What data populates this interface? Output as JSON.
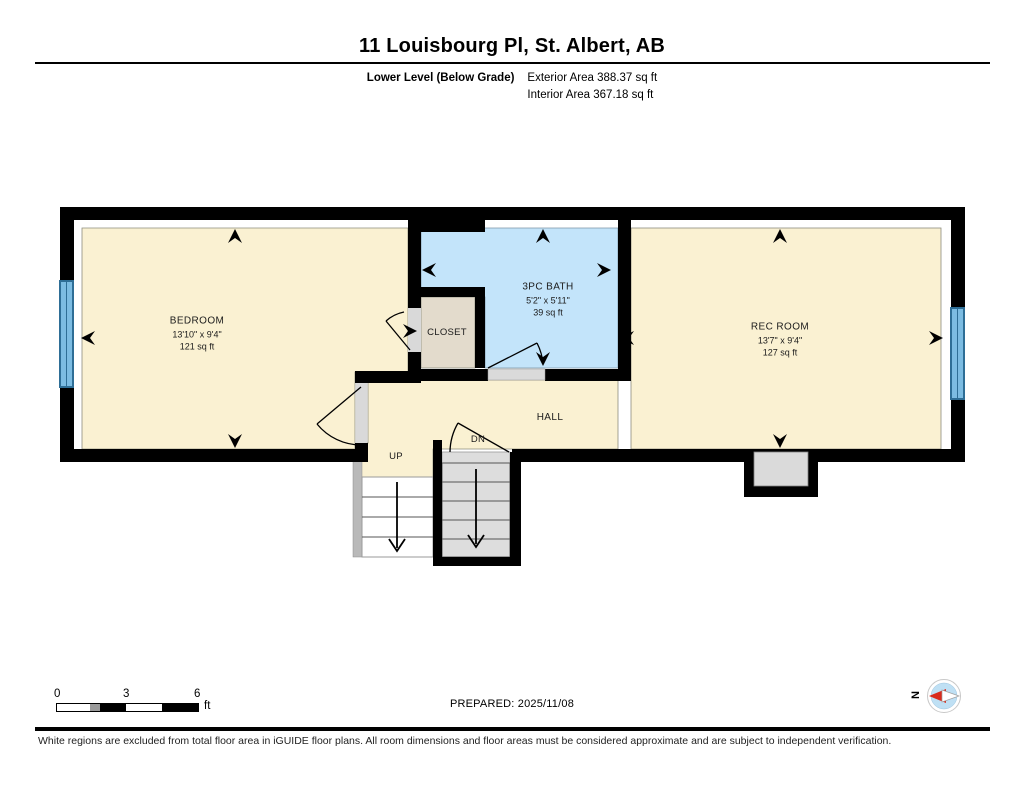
{
  "header": {
    "title": "11 Louisbourg Pl, St. Albert, AB",
    "level_label": "Lower Level (Below Grade)",
    "exterior_area": "Exterior Area 388.37 sq ft",
    "interior_area": "Interior Area 367.18 sq ft"
  },
  "rooms": {
    "bedroom": {
      "name": "BEDROOM",
      "dims": "13'10\" x 9'4\"",
      "area": "121 sq ft"
    },
    "bath": {
      "name": "3PC BATH",
      "dims": "5'2\" x 5'11\"",
      "area": "39 sq ft"
    },
    "closet": {
      "name": "CLOSET"
    },
    "rec_room": {
      "name": "REC ROOM",
      "dims": "13'7\" x 9'4\"",
      "area": "127 sq ft"
    },
    "hall": {
      "name": "HALL"
    },
    "stairs": {
      "up": "UP",
      "down": "DN"
    }
  },
  "footer": {
    "scale": {
      "t0": "0",
      "t3": "3",
      "t6": "6",
      "unit": "ft"
    },
    "prepared": "PREPARED: 2025/11/08",
    "compass": "N",
    "disclaimer": "White regions are excluded from total floor area in iGUIDE floor plans. All room dimensions and floor areas must be considered approximate and are subject to independent verification."
  },
  "colors": {
    "wall": "#000000",
    "room_fill": "#FAF1D2",
    "bath_fill": "#C3E4FA",
    "closet_fill": "#E3DBCC",
    "stair_fill": "#DDDDDD",
    "window": "#7CBCE2",
    "compass_red": "#D92B1C"
  }
}
